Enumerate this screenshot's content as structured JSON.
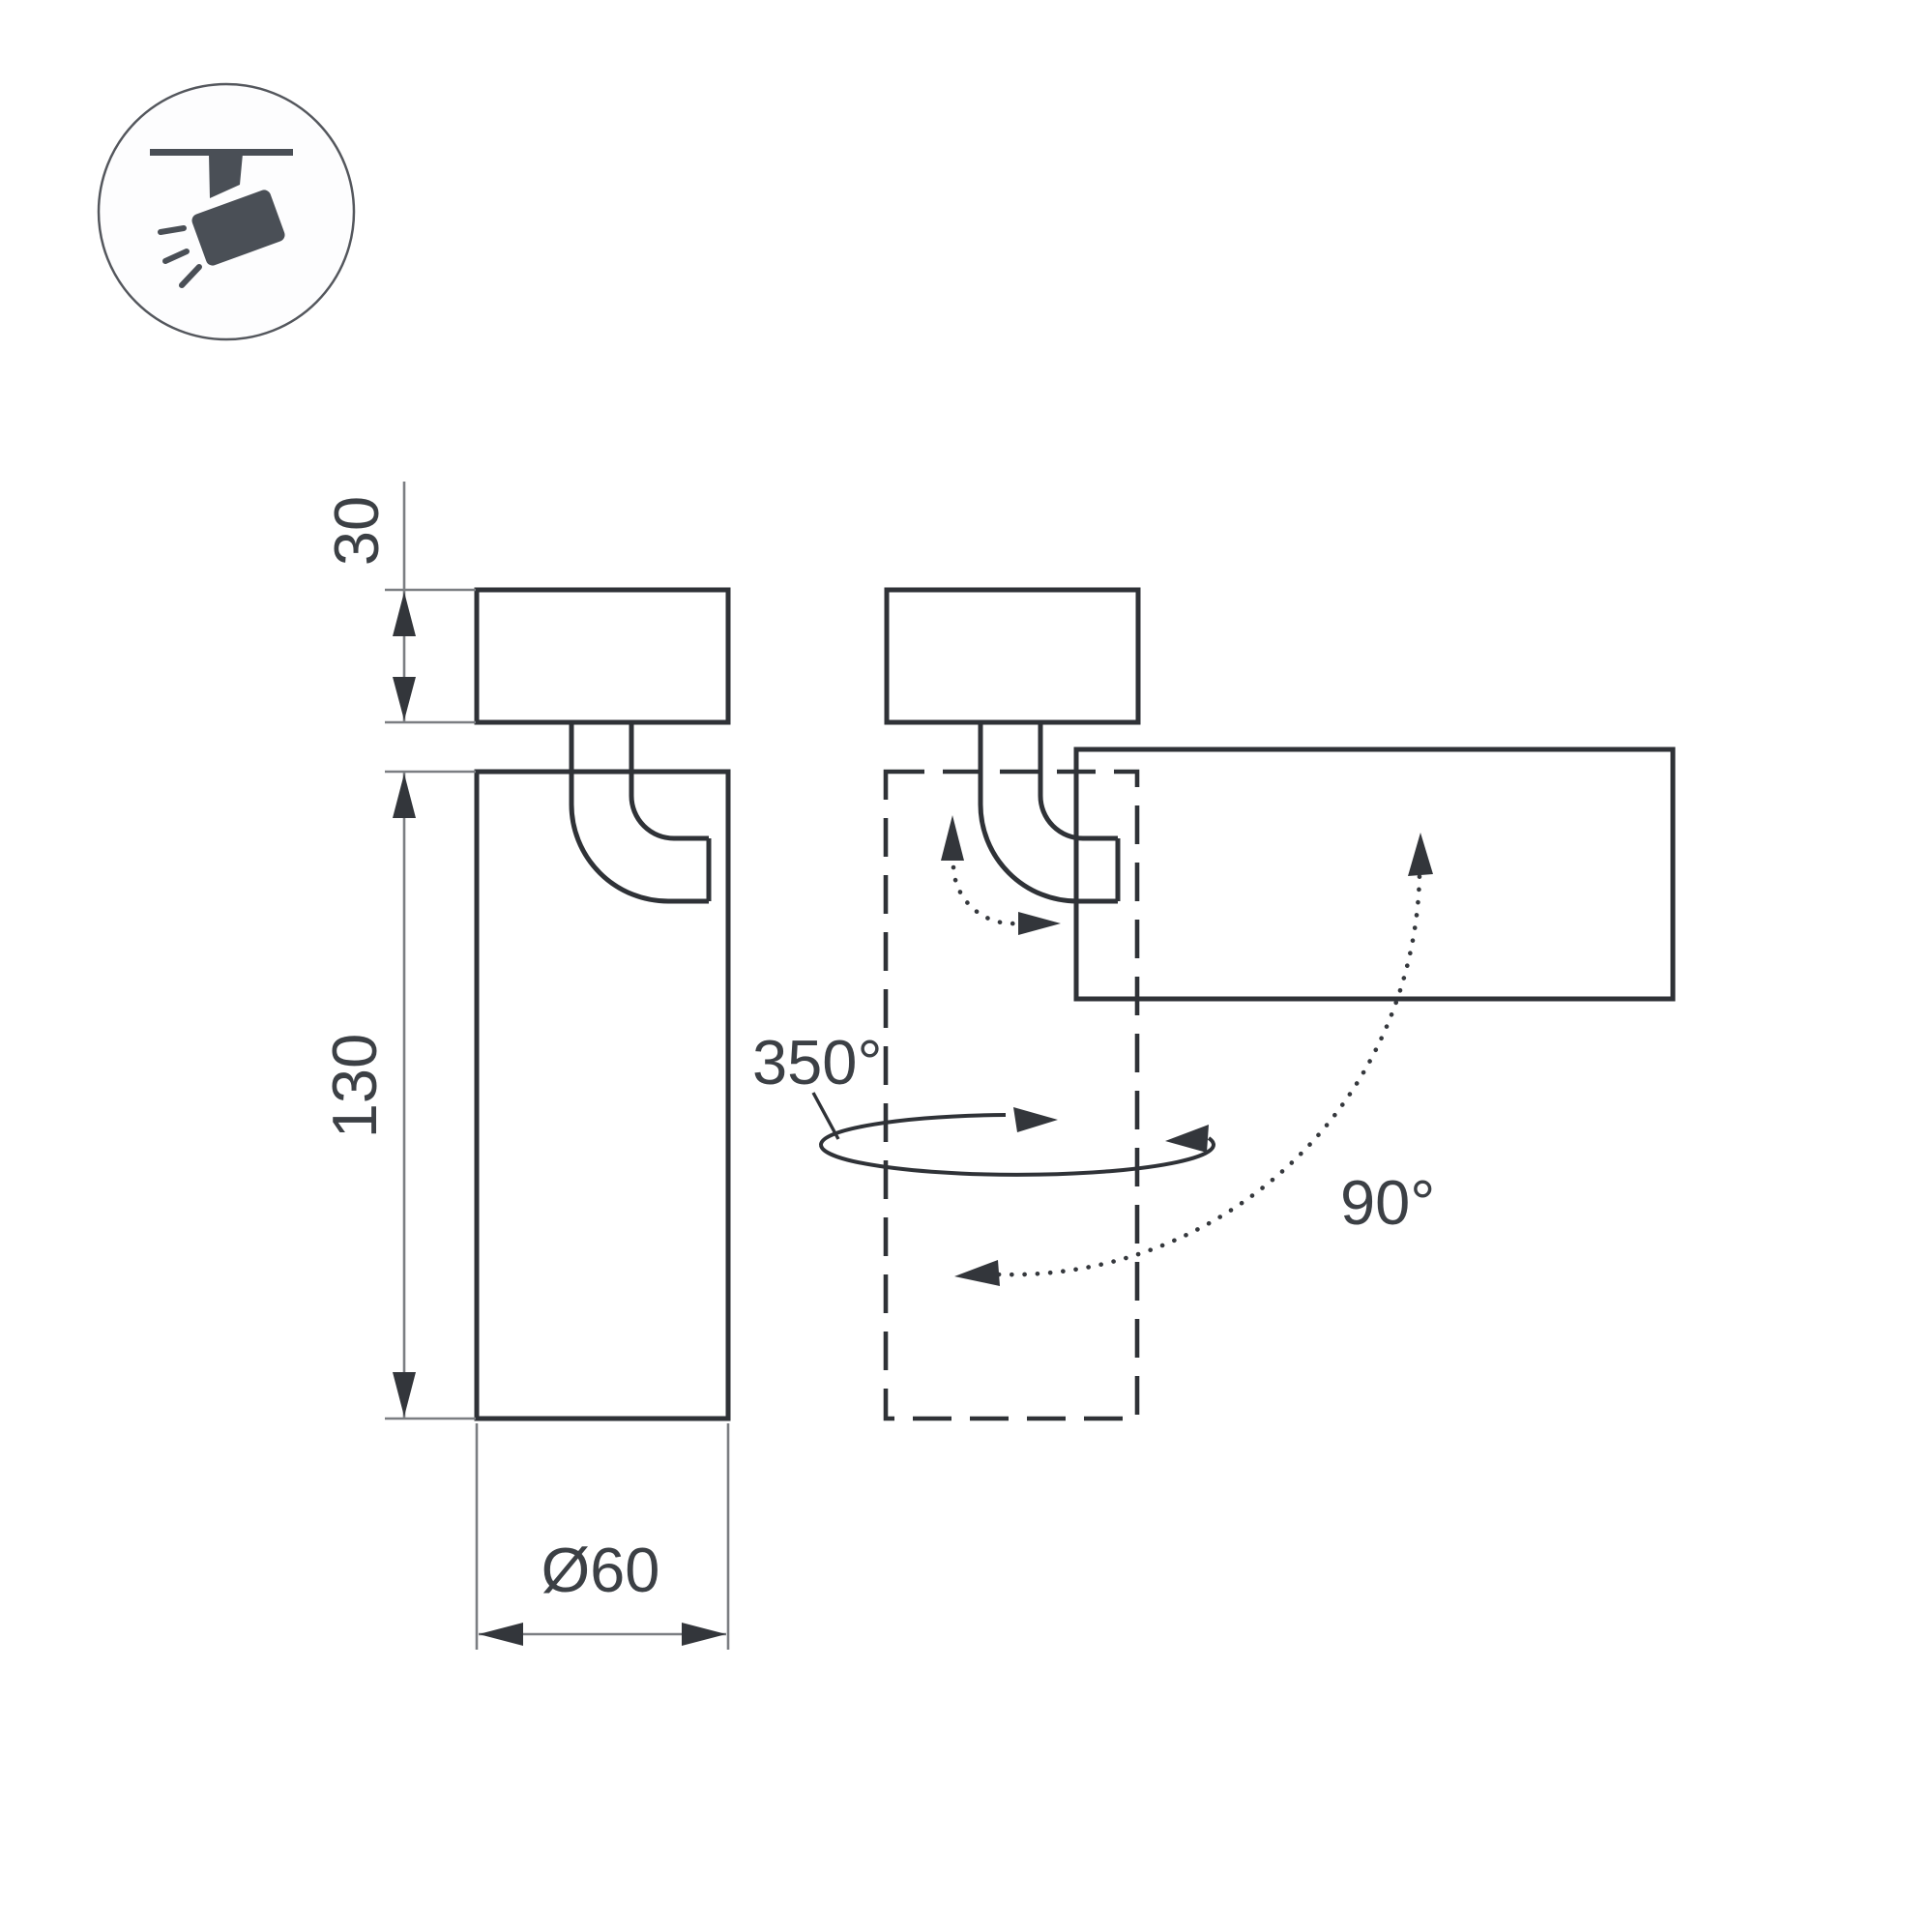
{
  "drawing": {
    "kind": "spotlight-dimension-diagram",
    "labels": {
      "base_height": "30",
      "body_height": "130",
      "diameter": "Ø60",
      "pan_angle": "350°",
      "tilt_angle": "90°"
    },
    "icon": {
      "name": "ceiling-spotlight-icon"
    },
    "colors": {
      "outline": "#2f3237",
      "thin_line": "#7b7e82",
      "arrow": "#33363b",
      "text": "#3c4045",
      "icon_fill": "#4a4f56",
      "background": "#ffffff"
    }
  }
}
